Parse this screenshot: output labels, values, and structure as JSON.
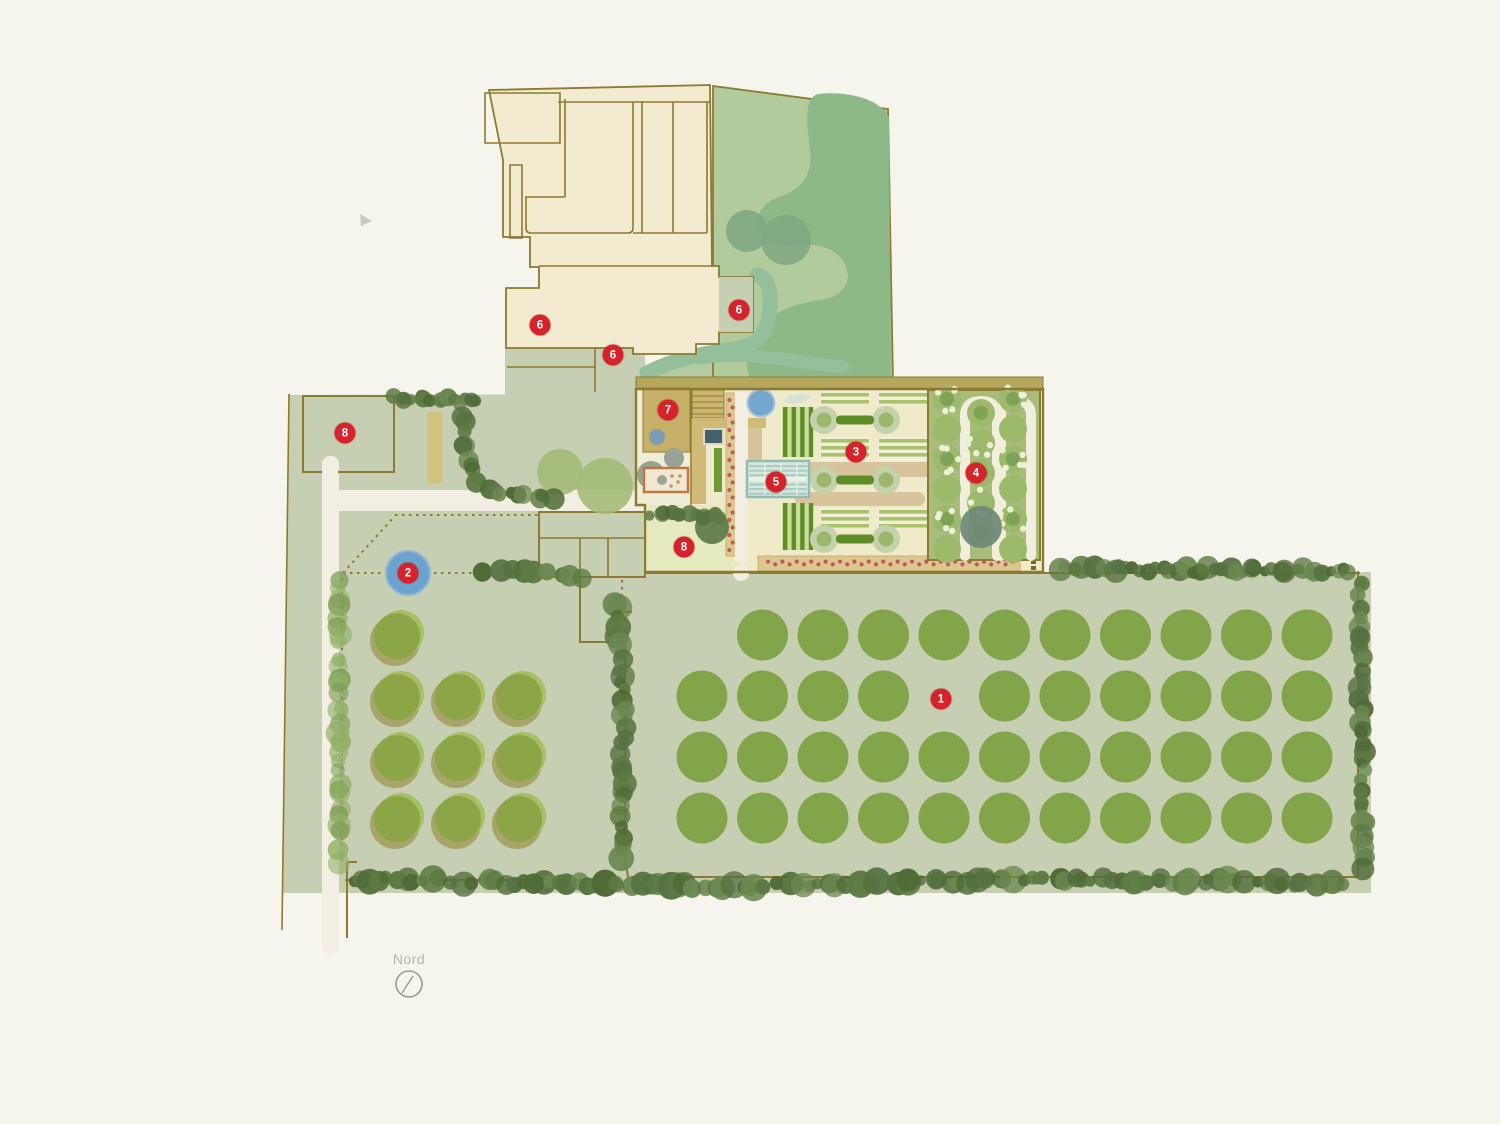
{
  "compass": {
    "label": "Nord"
  },
  "markers": [
    {
      "label": "1",
      "x": 941,
      "y": 699
    },
    {
      "label": "2",
      "x": 408,
      "y": 573
    },
    {
      "label": "3",
      "x": 856,
      "y": 452
    },
    {
      "label": "4",
      "x": 976,
      "y": 473
    },
    {
      "label": "5",
      "x": 776,
      "y": 482
    },
    {
      "label": "6",
      "x": 540,
      "y": 325
    },
    {
      "label": "6",
      "x": 739,
      "y": 310
    },
    {
      "label": "6",
      "x": 613,
      "y": 355
    },
    {
      "label": "7",
      "x": 668,
      "y": 410
    },
    {
      "label": "8",
      "x": 345,
      "y": 433
    },
    {
      "label": "8",
      "x": 684,
      "y": 547
    }
  ],
  "palette": {
    "page_bg": "#f6f5ed",
    "marker_red": "#d6232b",
    "olive_line": "#8c7a31",
    "building_cream": "#f2ebd0",
    "lawn_light": "#b2cb9c",
    "lawn_dark": "#8db989",
    "teal_band": "#93bf9b",
    "sage": "#c6cfb2",
    "orchard_green": "#83a549",
    "orchard_yellow_green": "#8ca547",
    "hedge_dark": "#55703b",
    "water_blue": "#74a7cd",
    "path_tan": "#d7c49c",
    "flower_dot_red": "#c4595f"
  }
}
